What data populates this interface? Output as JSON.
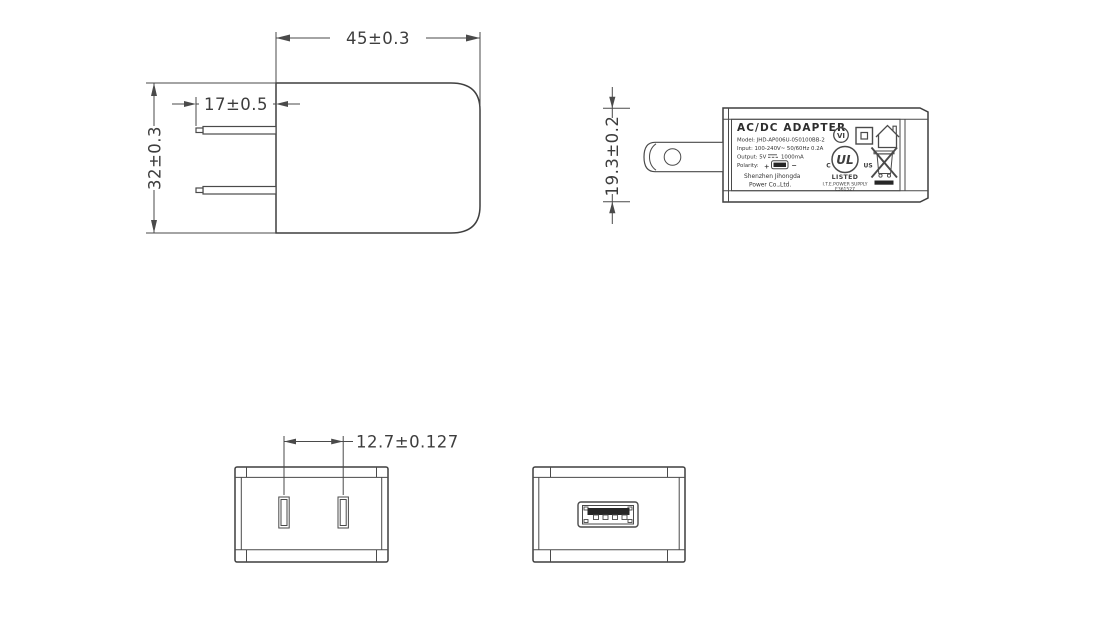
{
  "dimensions": {
    "body_width": "45±0.3",
    "prong_length": "17±0.5",
    "body_height": "32±0.3",
    "body_thickness": "19.3±0.2",
    "prong_spacing": "12.7±0.127"
  },
  "label": {
    "title": "AC/DC  ADAPTER",
    "model_line": "Model: JHD-AP006U-050100BB-2",
    "input_line": "Input: 100-240V~ 50/60Hz 0.2A",
    "output_prefix": "Output: 5V",
    "output_suffix": "1000mA",
    "polarity_label": "Polarity:",
    "polarity_plus": "+",
    "polarity_minus": "−",
    "company_line1": "Shenzhen Jihongda",
    "company_line2": "Power Co.,Ltd.",
    "efficiency_mark": "VI",
    "ul_mark": {
      "letters": "UL",
      "c_prefix": "C",
      "us_suffix": "US",
      "listed": "LISTED",
      "category": "I.T.E.POWER SUPPLY",
      "file_number": "E361527"
    }
  },
  "colors": {
    "background": "#ffffff",
    "line": "#4a4a4a",
    "text": "#3d3d3d",
    "usb_tongue": "#262626"
  }
}
